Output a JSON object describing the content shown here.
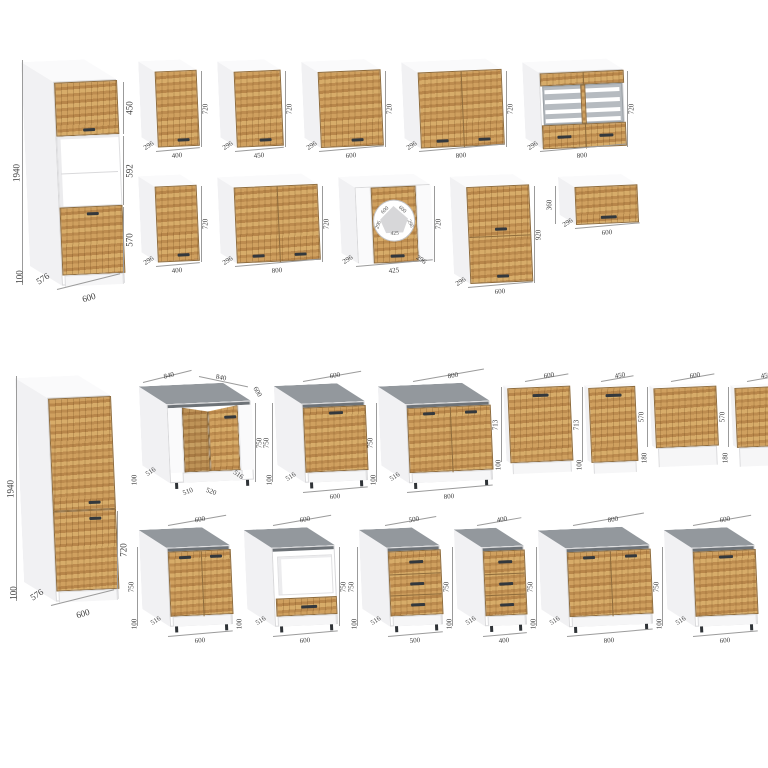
{
  "page": {
    "background": "#ffffff"
  },
  "colors": {
    "wood_light": "#d7ac69",
    "wood_mid": "#cfa05f",
    "wood_dark": "#b8864a",
    "countertop": "#93989d",
    "countertop_edge": "#6d7277",
    "carcass_white": "#f1f1f3",
    "handle": "#33383d",
    "dimension_text": "#3b3b3b"
  },
  "sections": {
    "top": {
      "tall": {
        "name": "tall-oven-housing-600",
        "kind": "tall",
        "w": 600,
        "h": 1940,
        "d": 576,
        "segments": [
          {
            "type": "wood",
            "mm": 450,
            "handle": "bc",
            "label": "450"
          },
          {
            "type": "open",
            "mm": 592,
            "label": "592"
          },
          {
            "type": "wood",
            "mm": 570,
            "handle": "tc",
            "label": "570"
          }
        ],
        "labels": {
          "left_h": "1940",
          "plinth": "100",
          "depth": "576",
          "bottom": "600"
        }
      },
      "rows": [
        [
          {
            "name": "wall-400",
            "kind": "wall",
            "w": 400,
            "h": 720,
            "d": 296,
            "doors": 1,
            "labels": {
              "bottom": "400",
              "right_h": "720",
              "depth": "296"
            }
          },
          {
            "name": "wall-450",
            "kind": "wall",
            "w": 450,
            "h": 720,
            "d": 296,
            "doors": 1,
            "labels": {
              "bottom": "450",
              "right_h": "720",
              "depth": "296"
            }
          },
          {
            "name": "wall-600",
            "kind": "wall",
            "w": 600,
            "h": 720,
            "d": 296,
            "doors": 1,
            "labels": {
              "bottom": "600",
              "right_h": "720",
              "depth": "296"
            }
          },
          {
            "name": "wall-800",
            "kind": "wall",
            "w": 800,
            "h": 720,
            "d": 296,
            "doors": 2,
            "labels": {
              "bottom": "800",
              "right_h": "720",
              "depth": "296"
            }
          },
          {
            "name": "wall-glass-800",
            "kind": "glass",
            "w": 800,
            "h": 720,
            "d": 296,
            "doors": 2,
            "labels": {
              "bottom": "800",
              "right_h": "720",
              "depth": "296"
            }
          }
        ],
        [
          {
            "name": "wall-400-b",
            "kind": "wall",
            "w": 400,
            "h": 720,
            "d": 296,
            "doors": 1,
            "labels": {
              "bottom": "400",
              "right_h": "720",
              "depth": "296"
            }
          },
          {
            "name": "wall-800-b",
            "kind": "wall",
            "w": 800,
            "h": 720,
            "d": 296,
            "doors": 2,
            "labels": {
              "bottom": "800",
              "right_h": "720",
              "depth": "296"
            }
          },
          {
            "name": "wall-corner-600",
            "kind": "corner-wall",
            "w": 425,
            "h": 720,
            "d": 296,
            "labels": {
              "bottom": "425",
              "right_h": "720",
              "depth_l": "296",
              "depth_r": "296"
            },
            "plan": {
              "top_left": "600",
              "top_right": "600",
              "side_left": "296",
              "side_right": "296",
              "front": "425"
            }
          },
          {
            "name": "wall-stacked-600",
            "kind": "stacked",
            "w": 600,
            "h": 920,
            "d": 296,
            "labels": {
              "bottom": "600",
              "right_h": "920",
              "depth": "296"
            }
          },
          {
            "name": "wall-flap-600",
            "kind": "flap",
            "w": 600,
            "h": 360,
            "d": 296,
            "labels": {
              "bottom": "600",
              "left_h": "360",
              "depth": "296"
            }
          }
        ]
      ]
    },
    "bottom": {
      "tall": {
        "name": "tall-pantry-600",
        "kind": "tall",
        "w": 600,
        "h": 1940,
        "d": 576,
        "segments": [
          {
            "type": "wood",
            "mm": 1020,
            "handle": "br",
            "label": ""
          },
          {
            "type": "wood",
            "mm": 720,
            "handle": "tr",
            "label": "720"
          }
        ],
        "labels": {
          "left_h": "1940",
          "plinth": "100",
          "depth": "576",
          "bottom": "600"
        }
      },
      "rows": [
        [
          {
            "name": "base-corner-840",
            "kind": "corner-base",
            "w": 840,
            "h": 750,
            "d": 516,
            "labels": {
              "top_left": "840",
              "top_right": "840",
              "top_small": "600",
              "right_h": "750",
              "depth_l": "516",
              "depth_r": "516",
              "front_l": "510",
              "front_r": "520",
              "plinth": "100"
            }
          },
          {
            "name": "base-600",
            "kind": "base",
            "w": 600,
            "h": 750,
            "d": 516,
            "doors": 1,
            "labels": {
              "top": "600",
              "left_h": "750",
              "depth": "516",
              "plinth": "100",
              "bottom": "600"
            }
          },
          {
            "name": "base-800",
            "kind": "base",
            "w": 800,
            "h": 750,
            "d": 516,
            "doors": 2,
            "labels": {
              "top": "800",
              "left_h": "750",
              "depth": "516",
              "plinth": "100",
              "bottom": "800"
            }
          },
          {
            "name": "dw-front-600-713",
            "kind": "panel",
            "w": 600,
            "h": 713,
            "plinth_mm": 100,
            "handle": true,
            "labels": {
              "top": "600",
              "left_h": "713",
              "plinth": "100"
            }
          },
          {
            "name": "dw-front-450-713",
            "kind": "panel",
            "w": 450,
            "h": 713,
            "plinth_mm": 100,
            "handle": true,
            "labels": {
              "top": "450",
              "left_h": "713",
              "plinth": "100"
            }
          },
          {
            "name": "dw-front-600-570",
            "kind": "panel",
            "w": 600,
            "h": 570,
            "plinth_mm": 180,
            "handle": false,
            "labels": {
              "top": "600",
              "left_h": "570",
              "plinth": "180"
            }
          },
          {
            "name": "dw-front-450-570",
            "kind": "panel",
            "w": 450,
            "h": 570,
            "plinth_mm": 180,
            "handle": false,
            "labels": {
              "top": "450",
              "left_h": "570",
              "plinth": "180"
            }
          }
        ],
        [
          {
            "name": "base-sink-600",
            "kind": "base",
            "w": 600,
            "h": 750,
            "d": 516,
            "doors": 2,
            "labels": {
              "top": "600",
              "left_h": "750",
              "depth": "516",
              "plinth": "100",
              "bottom": "600"
            }
          },
          {
            "name": "base-oven-600",
            "kind": "base",
            "oven": true,
            "w": 600,
            "h": 750,
            "d": 516,
            "labels": {
              "top": "600",
              "right_h": "750",
              "depth": "516",
              "plinth": "100",
              "bottom": "600"
            }
          },
          {
            "name": "base-drawers-500",
            "kind": "base",
            "drawers": 3,
            "w": 500,
            "h": 750,
            "d": 516,
            "labels": {
              "top": "500",
              "left_h": "750",
              "depth": "516",
              "plinth": "100",
              "bottom": "500"
            }
          },
          {
            "name": "base-drawers-400",
            "kind": "base",
            "drawers": 3,
            "w": 400,
            "h": 750,
            "d": 516,
            "labels": {
              "top": "400",
              "left_h": "750",
              "depth": "516",
              "plinth": "100",
              "bottom": "400"
            }
          },
          {
            "name": "base-800-b",
            "kind": "base",
            "w": 800,
            "h": 750,
            "d": 516,
            "doors": 2,
            "labels": {
              "top": "800",
              "left_h": "750",
              "depth": "516",
              "plinth": "100",
              "bottom": "800"
            }
          },
          {
            "name": "base-600-b",
            "kind": "base",
            "w": 600,
            "h": 750,
            "d": 516,
            "doors": 1,
            "labels": {
              "top": "600",
              "left_h": "750",
              "depth": "516",
              "plinth": "100",
              "bottom": "600"
            }
          }
        ]
      ]
    }
  }
}
